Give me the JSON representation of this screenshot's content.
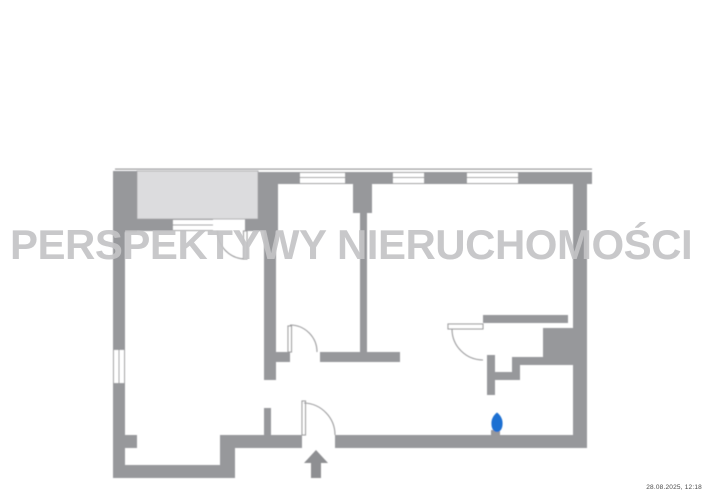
{
  "watermark": {
    "text": "PERSPEKTYWY NIERUCHOMOŚCI"
  },
  "timestamp": {
    "text": "28.08.2025, 12:18"
  },
  "colors": {
    "paper": "#ffffff",
    "wall": "#97989b",
    "balcony-fill": "#dcdcde",
    "balcony-border": "#b2b2b4",
    "line": "#9b9b9d",
    "watermark": "#c4c4c6",
    "accent-blue": "#1e6fd2",
    "arrow": "#8e8f92",
    "timestamp": "#4a4a4a"
  },
  "symbols": {
    "entrance_arrow": "entrance direction arrow",
    "water_point": "blue water/utility marker",
    "doors": "quarter-circle door swings",
    "windows": "triple-line window symbols"
  }
}
